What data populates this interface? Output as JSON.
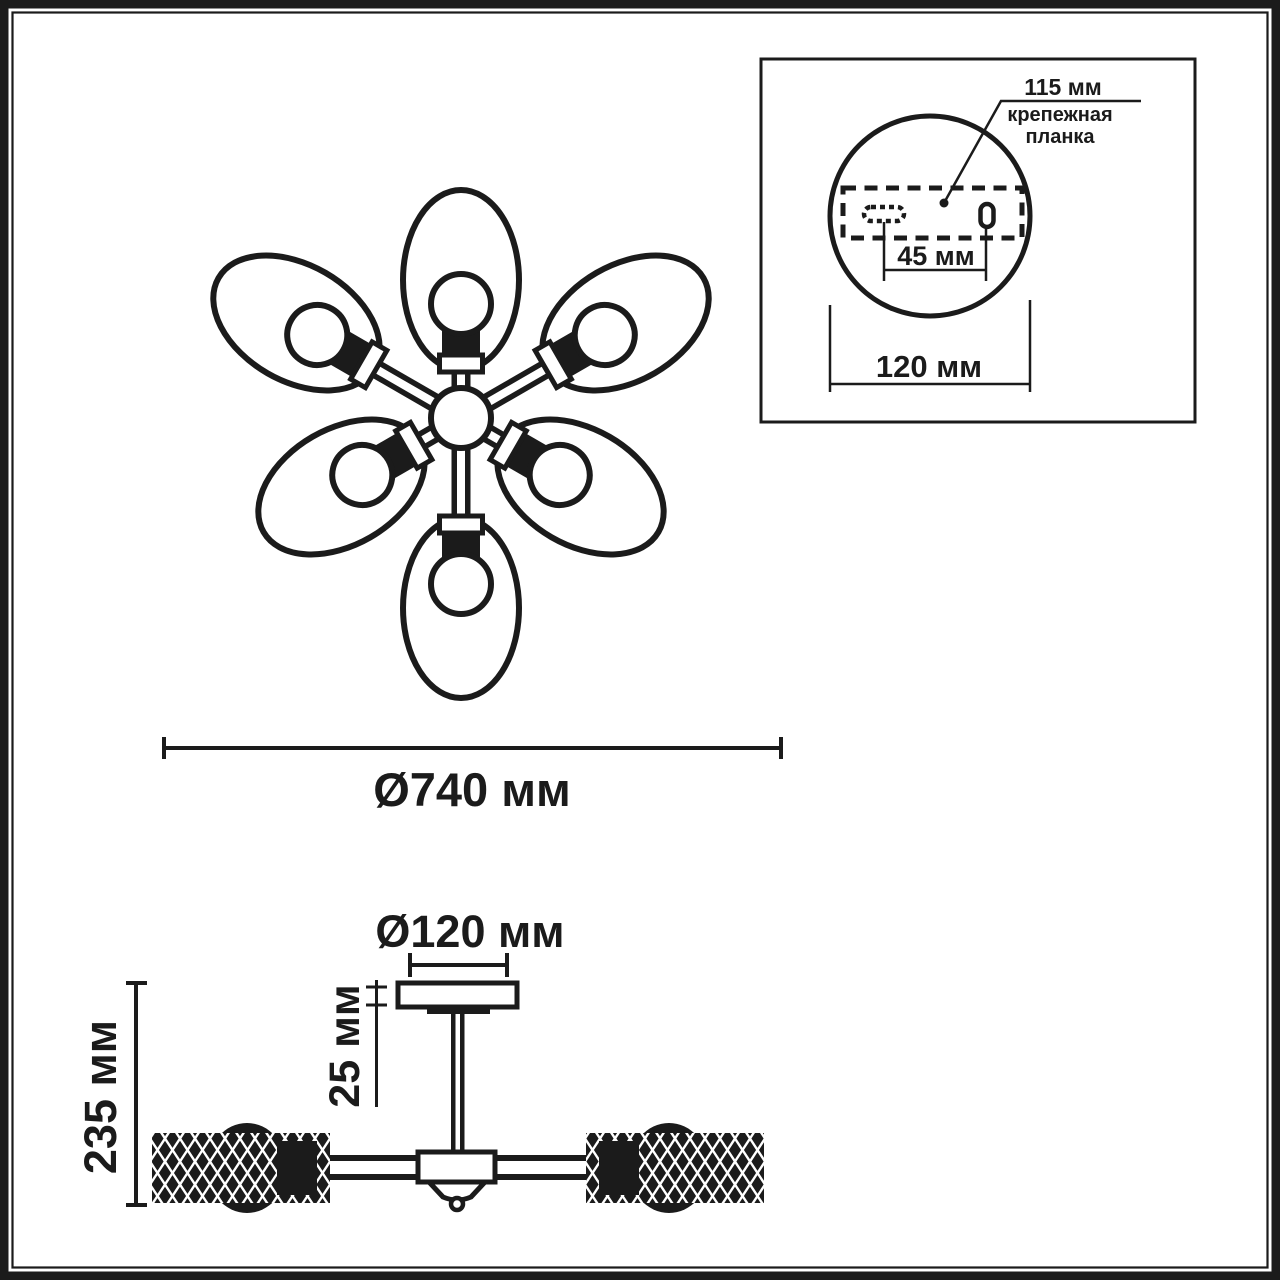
{
  "colors": {
    "ink": "#1b1b1b",
    "paper": "#ffffff"
  },
  "top_view": {
    "overall_diameter_label": "Ø740 мм"
  },
  "mount_detail": {
    "offset_label": "115 мм",
    "plate_label_line1": "крепежная",
    "plate_label_line2": "планка",
    "hole_spacing_label": "45 мм",
    "canopy_diameter_label": "120 мм"
  },
  "side_view": {
    "canopy_diameter_label": "Ø120 мм",
    "canopy_height_label": "25 мм",
    "overall_height_label": "235 мм"
  }
}
